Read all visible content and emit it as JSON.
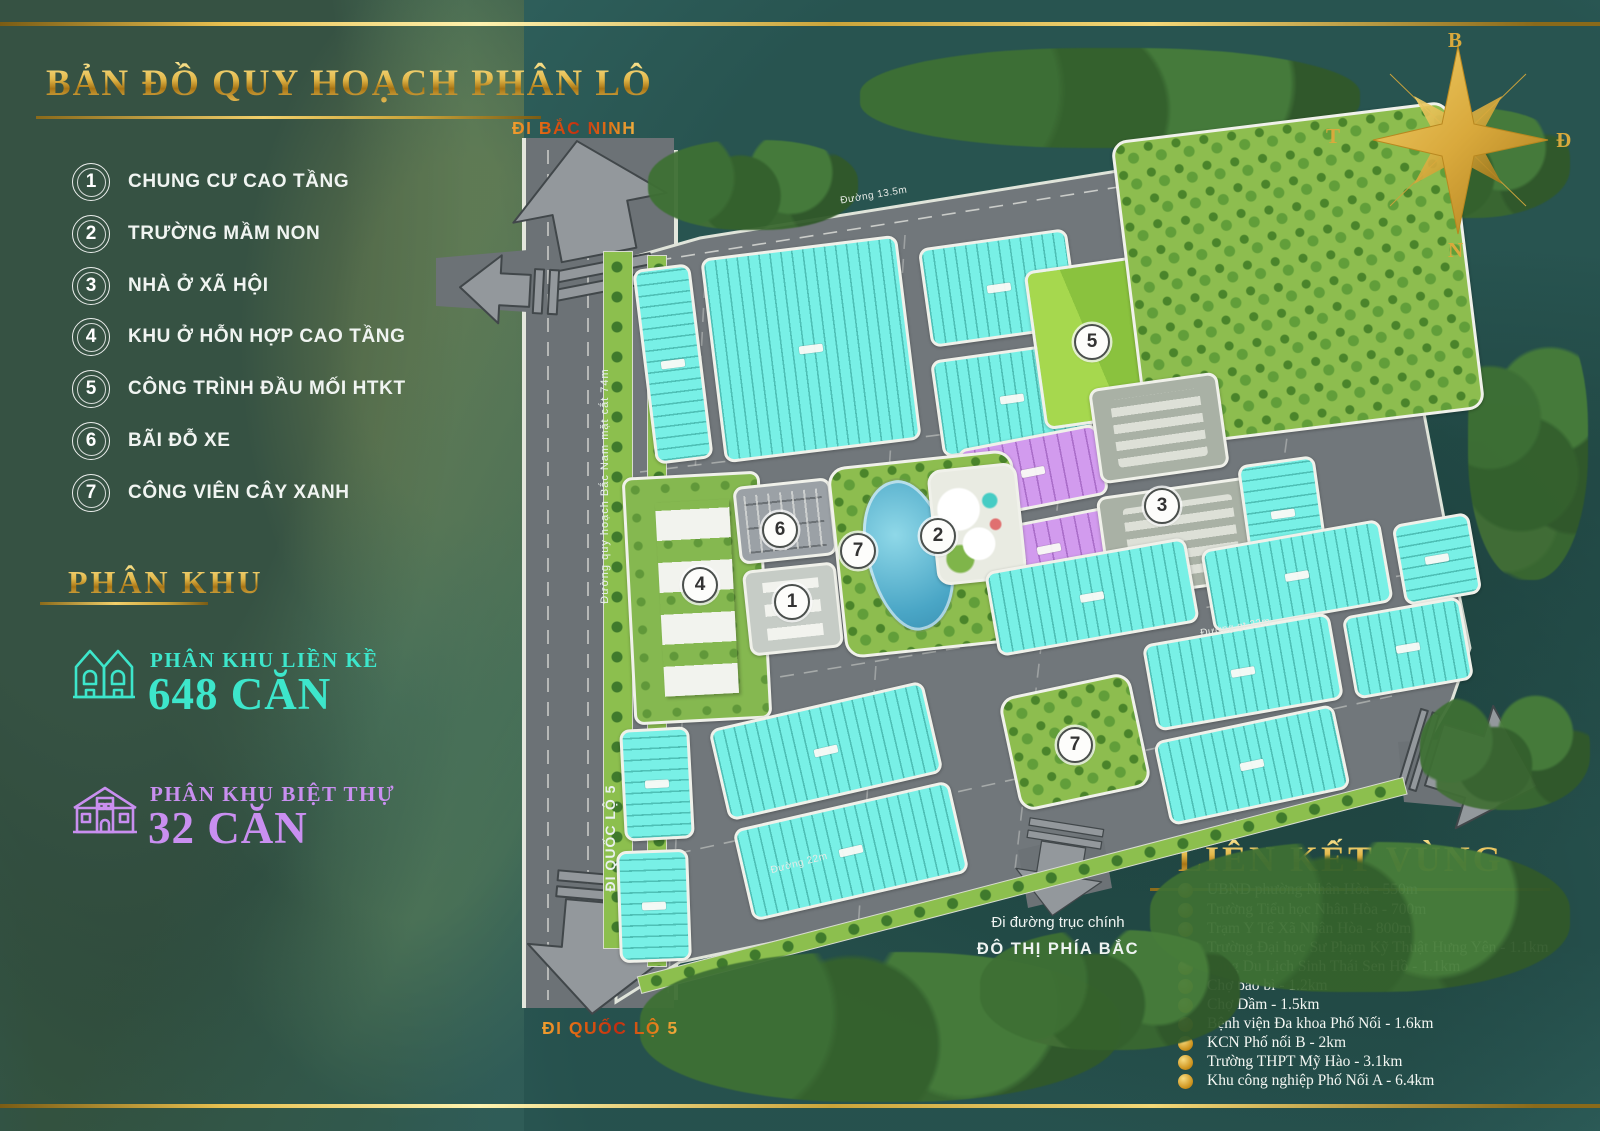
{
  "title": "BẢN ĐỒ QUY HOẠCH PHÂN LÔ",
  "legend": {
    "items": [
      {
        "num": "1",
        "label": "CHUNG CƯ CAO TẦNG"
      },
      {
        "num": "2",
        "label": "TRƯỜNG MẦM NON"
      },
      {
        "num": "3",
        "label": "NHÀ Ở XÃ HỘI"
      },
      {
        "num": "4",
        "label": "KHU Ở HỖN HỢP CAO TẦNG"
      },
      {
        "num": "5",
        "label": "CÔNG TRÌNH ĐẦU MỐI HTKT"
      },
      {
        "num": "6",
        "label": "BÃI ĐỖ XE"
      },
      {
        "num": "7",
        "label": "CÔNG VIÊN CÂY XANH"
      }
    ]
  },
  "phan_khu": {
    "heading": "PHÂN KHU",
    "lien_ke": {
      "label": "PHÂN KHU LIỀN KỀ",
      "value": "648 CĂN"
    },
    "biet_thu": {
      "label": "PHÂN KHU BIỆT THỰ",
      "value": "32 CĂN"
    }
  },
  "compass": {
    "north": "B",
    "east": "Đ",
    "south": "N",
    "west": "T"
  },
  "directions": {
    "north": "ĐI BẮC NINH",
    "south": "ĐI QUỐC LỘ 5",
    "axis1": "Đi đường trục chính",
    "axis2": "ĐÔ THỊ PHÍA BẮC"
  },
  "roads": {
    "west_axis": "Đường quy hoạch Bắc Nam mặt cắt 74m",
    "west_dir": "ĐI QUỐC LỘ 5",
    "top": "Đường 13.5m",
    "bottom": "Đường 22m",
    "mid": "Đường gt 22m"
  },
  "map": {
    "markers": [
      "4",
      "6",
      "1",
      "7",
      "2",
      "5",
      "3",
      "7"
    ]
  },
  "lien_ket_vung": {
    "heading": "LIÊN KẾT VÙNG",
    "items": [
      "UBND phường Nhân Hòa - 550m",
      "Trường Tiểu học Nhân Hòa - 700m",
      "Trạm Y Tế Xã Nhân Hòa - 800m",
      "Trường Đại học Sư Phạm Kỹ Thuật Hưng Yên - 1.1km",
      "Làng Du Lịch Sinh Thái Sen Hồ - 1.1km",
      "Chợ bao bì - 1.2km",
      "Chợ Dầm - 1.5km",
      "Bệnh viện Đa khoa Phố Nối - 1.6km",
      "KCN Phố nối B - 2km",
      "Trường THPT Mỹ Hào - 3.1km",
      "Khu công nghiệp Phố Nối A - 6.4km"
    ]
  },
  "colors": {
    "gold": "#d9a93c",
    "teal_accent": "#3de6cb",
    "purple_accent": "#c98ff0",
    "cyan_lot": "#78f0e6",
    "villa_lot": "#d29bee",
    "park_green": "#8dbd4f",
    "road_gray": "#6c7276",
    "background_teal": "#30625e",
    "direction_red": "#c22c10"
  }
}
